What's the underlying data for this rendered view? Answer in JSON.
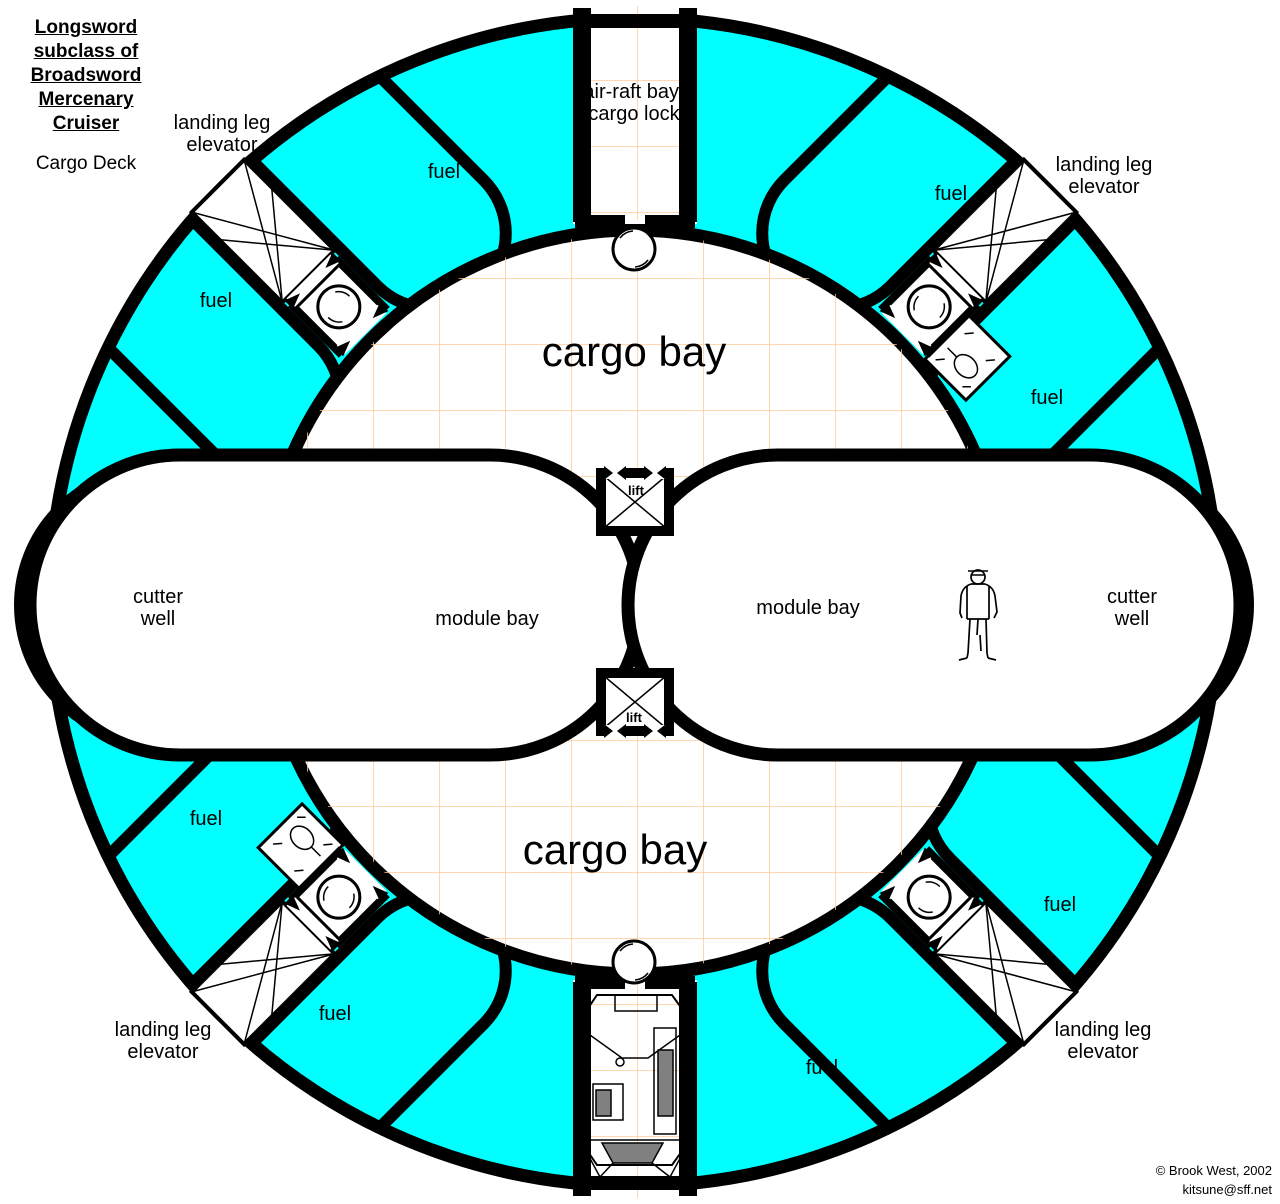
{
  "title": {
    "lines": [
      "Longsword",
      "subclass of",
      "Broadsword",
      "Mercenary",
      "Cruiser"
    ],
    "deck": "Cargo Deck"
  },
  "rooms": {
    "air_raft_line1": "air-raft bay/",
    "air_raft_line2": "cargo lock",
    "cargo_bay": "cargo bay",
    "module_bay": "module bay",
    "cutter_line1": "cutter",
    "cutter_line2": "well",
    "fuel": "fuel",
    "landing_line1": "landing leg",
    "landing_line2": "elevator",
    "lift": "lift"
  },
  "credits": {
    "line1": "© Brook West, 2002",
    "line2": "kitsune@sff.net"
  },
  "colors": {
    "fuel": "#00FFFF",
    "grid": "#FFCC99",
    "wall": "#000000",
    "cutter_well": "#FFFFCC",
    "panel": "#808080"
  }
}
